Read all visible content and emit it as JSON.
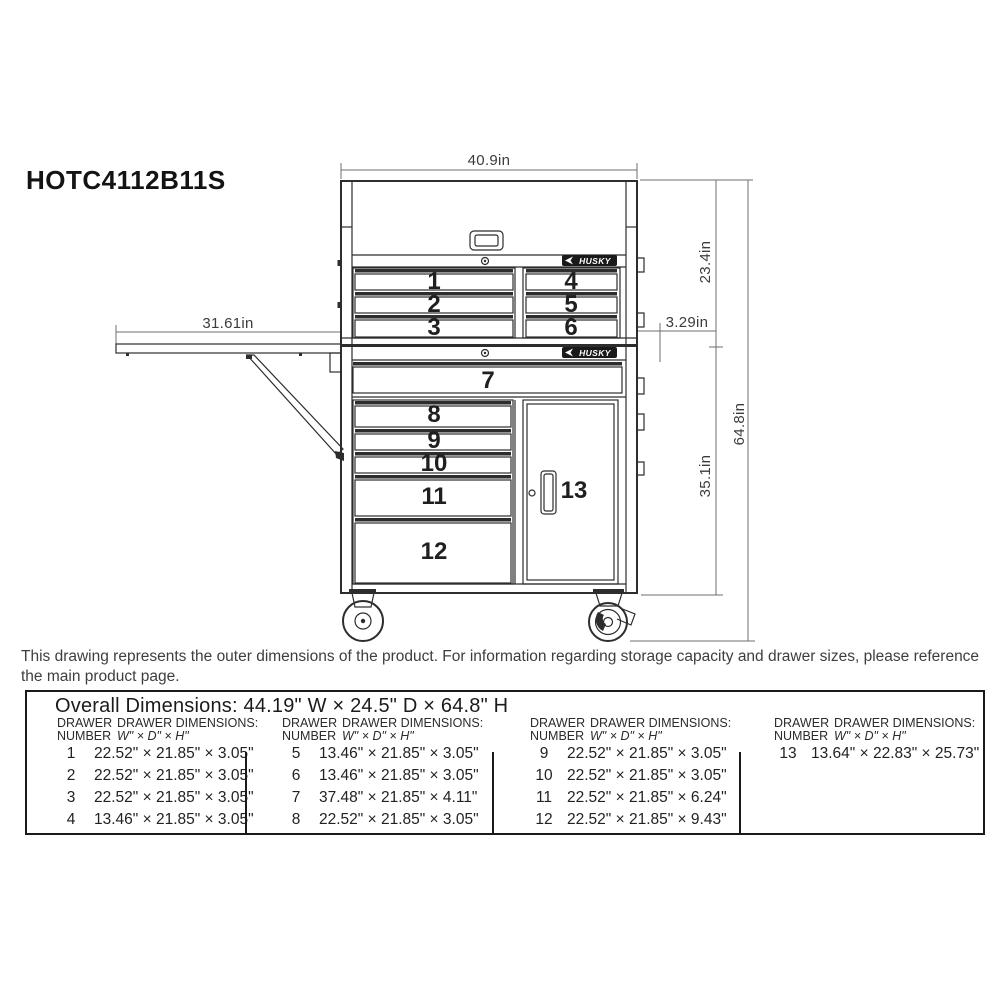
{
  "page": {
    "model_number": "HOTC4112B11S",
    "note": "This drawing represents the outer dimensions of the product. For information regarding storage capacity and drawer sizes, please reference the main product page."
  },
  "drawing": {
    "brand": "HUSKY",
    "drawer_labels": [
      "1",
      "2",
      "3",
      "4",
      "5",
      "6",
      "7",
      "8",
      "9",
      "10",
      "11",
      "12",
      "13"
    ],
    "dimensions": {
      "chest_width": "40.9in",
      "chest_height": "23.4in",
      "side_offset": "3.29in",
      "overall_height": "64.8in",
      "cabinet_height": "35.1in",
      "shelf_width": "31.61in"
    }
  },
  "table": {
    "overall": "Overall Dimensions: 44.19\" W × 24.5\" D × 64.8\" H",
    "header": {
      "number_line1": "DRAWER",
      "number_line2": "NUMBER",
      "dims_line1": "DRAWER DIMENSIONS:",
      "dims_line2": "W\" × D\" × H\""
    },
    "groups": [
      {
        "rows": [
          {
            "num": "1",
            "dims": "22.52\" × 21.85\" × 3.05\""
          },
          {
            "num": "2",
            "dims": "22.52\" × 21.85\" × 3.05\""
          },
          {
            "num": "3",
            "dims": "22.52\" × 21.85\" × 3.05\""
          },
          {
            "num": "4",
            "dims": "13.46\" × 21.85\" × 3.05\""
          }
        ]
      },
      {
        "rows": [
          {
            "num": "5",
            "dims": "13.46\" × 21.85\" × 3.05\""
          },
          {
            "num": "6",
            "dims": "13.46\" × 21.85\" × 3.05\""
          },
          {
            "num": "7",
            "dims": "37.48\" × 21.85\" × 4.11\""
          },
          {
            "num": "8",
            "dims": "22.52\" × 21.85\" × 3.05\""
          }
        ]
      },
      {
        "rows": [
          {
            "num": "9",
            "dims": "22.52\" × 21.85\" × 3.05\""
          },
          {
            "num": "10",
            "dims": "22.52\" × 21.85\" × 3.05\""
          },
          {
            "num": "11",
            "dims": "22.52\" × 21.85\" × 6.24\""
          },
          {
            "num": "12",
            "dims": "22.52\" × 21.85\" × 9.43\""
          }
        ]
      },
      {
        "rows": [
          {
            "num": "13",
            "dims": "13.64\" × 22.83\" × 25.73\""
          }
        ]
      }
    ]
  }
}
